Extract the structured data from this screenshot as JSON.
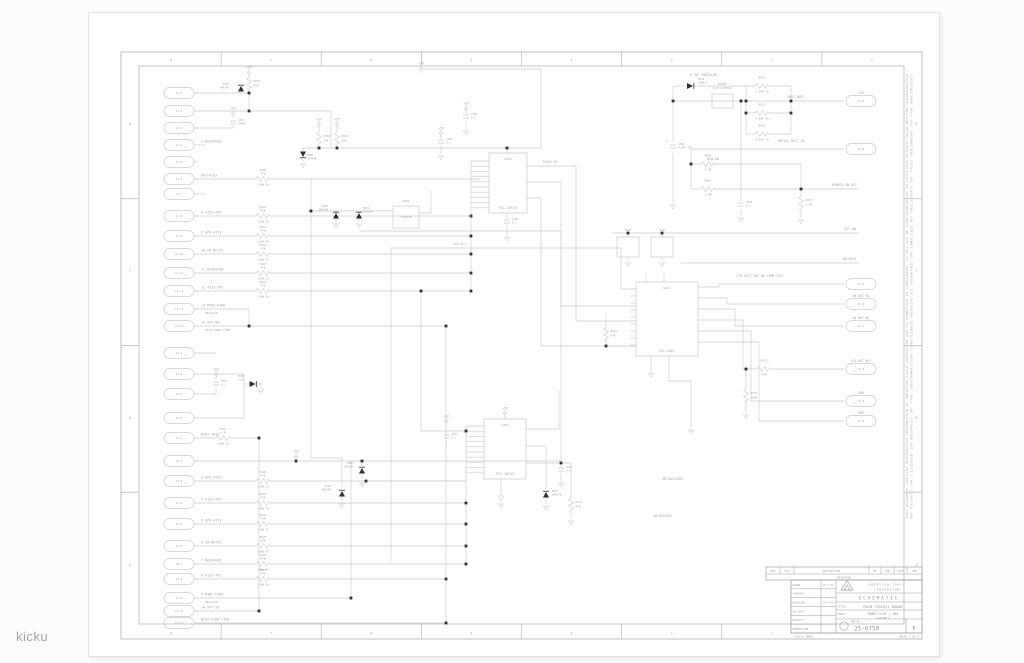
{
  "watermark": "kicku",
  "frame": {
    "zone_columns": [
      "8",
      "7",
      "6",
      "5",
      "4",
      "3",
      "2",
      "1"
    ],
    "zone_rows": [
      "D",
      "C",
      "B",
      "A"
    ],
    "notice_line1": "THIS DOCUMENT CONTAINS PROPRIETARY INFORMATION OF AMERICAN TOUCH CONVERSION AND IS SUBMITTED IN CONFIDENCE. IT MAY NOT BE USED REPRODUCED OR DISCLOSED WITHOUT PRIOR WRITTEN AUTHORIZATION",
    "notice_line2": "NO RIGHTS OR LICENSE IN RESPECT OF THE INFORMATION CONTAINED HEREIN IS GRANTED OR IMPLIED BY DELIVERY OF THIS DOCUMENT TO THE RECIPIENT"
  },
  "title_block": {
    "company_line1": "AMERICAN TOUCH",
    "company_line2": "CONVERSION",
    "doc_type": "SCHEMATIC",
    "title_label": "TITLE:",
    "title": "MAIN CIRCUIT BOARD",
    "model_label": "MODEL:",
    "model": "SMART-SLOT / 485",
    "model_sub": "ASSEMBLY",
    "dwg_label": "DWG NO:",
    "dwg_no": "25-0750",
    "rev": "F",
    "scale": "SCALE: NONE",
    "sheet": "SHEET 1 OF 1",
    "revisions_caption": "REVISIONS",
    "rev_header": [
      "REV",
      "ECO",
      "DESCRIPTION",
      "BY",
      "CHK",
      "DATE",
      "APP"
    ],
    "approvals": [
      {
        "label": "DRAWN",
        "date": "10-5-94"
      },
      {
        "label": "CHECKED",
        "date": ""
      },
      {
        "label": "RELEASED",
        "date": "10-5-94"
      },
      {
        "label": "DOC REP",
        "date": ""
      },
      {
        "label": "QUALITY",
        "date": ""
      },
      {
        "label": "PRODUCTION",
        "date": ""
      }
    ]
  },
  "schematic": {
    "power_label": "+5V",
    "res_tol": "1/8W 5%",
    "left_connectors": [
      {
        "pin": "J1-1",
        "net": ""
      },
      {
        "pin": "J1-2",
        "net": ""
      },
      {
        "pin": "J1-3",
        "net": ""
      },
      {
        "pin": "J1-4",
        "net": "C-RESERVED"
      },
      {
        "pin": "J1-5",
        "net": ""
      },
      {
        "pin": "J1-6",
        "net": "GPI-4153",
        "res_ref": "R506",
        "res_val": "47K"
      },
      {
        "pin": "J1-7",
        "net": ""
      },
      {
        "pin": "J1-8",
        "net": "8 4153-GPO",
        "res_ref": "R510",
        "res_val": "47K"
      },
      {
        "pin": "J1-9",
        "net": "9 GPO-4153",
        "res_ref": "R511",
        "res_val": "47K"
      },
      {
        "pin": "J1-10",
        "net": "10 CB-BUTTS",
        "res_ref": "R512",
        "res_val": "47K"
      },
      {
        "pin": "J1-11",
        "net": "11 RESERVED",
        "res_ref": "R513",
        "res_val": "47K"
      },
      {
        "pin": "J1-12",
        "net": "12 4153-TR2",
        "res_ref": "R514",
        "res_val": "47K"
      },
      {
        "pin": "J1-13",
        "net": "13 MINI-KIRK",
        "sub": "ON-5ACH"
      },
      {
        "pin": "J1-14",
        "net": "14 OFF-ON",
        "sub": "DIST-KIRK-TIME"
      },
      {
        "pin": "J2-1",
        "net": ""
      },
      {
        "pin": "J2-2",
        "net": ""
      },
      {
        "pin": "J2-3",
        "net": ""
      },
      {
        "pin": "J2-4",
        "net": ""
      },
      {
        "pin": "J3-1",
        "net": "A101-TRIG",
        "res_ref": "R527",
        "res_val": "4.7K"
      },
      {
        "pin": "J3-2",
        "net": ""
      },
      {
        "pin": "J3-3",
        "net": "3 GPA-4153",
        "res_ref": "R520",
        "res_val": "47K"
      },
      {
        "pin": "J3-4",
        "net": "4 4153-GPO",
        "res_ref": "R521",
        "res_val": "47K"
      },
      {
        "pin": "J3-5",
        "net": "5 GPO-4153",
        "res_ref": "R522",
        "res_val": "47K"
      },
      {
        "pin": "J3-6",
        "net": "6 CB-BUTTS",
        "res_ref": "R523",
        "res_val": "47K"
      },
      {
        "pin": "J3-7",
        "net": "7 RESERVED",
        "res_ref": "R524",
        "res_val": "47K"
      },
      {
        "pin": "J3-8",
        "net": "8 4153-TR2",
        "res_ref": "R525",
        "res_val": "47K"
      },
      {
        "pin": "J3-9",
        "net": "9 MINI-KIRK",
        "sub": "ON-5ACH"
      },
      {
        "pin": "J3-10",
        "net": "14 OFF-5A"
      },
      {
        "pin": "J3-11",
        "net": "BIAS-KIRK-TIME"
      }
    ],
    "right_connectors": [
      {
        "id": "J4-A",
        "net": "+5V"
      },
      {
        "id": "J4-B",
        "net": "SERIAL BATT-IN"
      },
      {
        "id": "J5-1",
        "net": "(FM 5472 SW7 NO LAMP FUS)"
      },
      {
        "id": "J5-2",
        "net": "SW BAT W2"
      },
      {
        "id": "J5-3",
        "net": "SW BAT W1"
      },
      {
        "id": "J5-4",
        "net": "(LO BAT NC)"
      },
      {
        "id": "J5-5",
        "net": "VDD"
      },
      {
        "id": "J5-6",
        "net": "VDD"
      }
    ],
    "net_labels": [
      {
        "text": "VBAT-BATT"
      },
      {
        "text": "BLW-ON"
      },
      {
        "text": "REMOTE ON-OFF"
      },
      {
        "text": "OFF-ON"
      },
      {
        "text": "ON-5ACH"
      },
      {
        "text": "R410-74L"
      },
      {
        "text": "SB74AC240SC"
      },
      {
        "text": "SB74AC04SC"
      },
      {
        "text": "+5V 0.1"
      },
      {
        "text": "0.1UF TANTALUM"
      }
    ],
    "ics": [
      {
        "ref": "U202",
        "part": "PIC-16C54"
      },
      {
        "ref": "U601",
        "part": "SSI-2661"
      },
      {
        "ref": "U402",
        "part": "PIC-16C54"
      }
    ],
    "parts": [
      {
        "ref": "BT650",
        "value": "3.6V LITHIUM"
      },
      {
        "ref": "Y601",
        "value": "3.58 MHZ"
      },
      {
        "ref": "Y602",
        "value": "32.768K"
      },
      {
        "ref": "U203",
        "value": "CD4070B"
      }
    ],
    "resistors": [
      {
        "ref": "R501",
        "value": "47K"
      },
      {
        "ref": "R504",
        "value": "10K"
      },
      {
        "ref": "R505",
        "value": "10K"
      },
      {
        "ref": "R651",
        "value": "1.00M 1%"
      },
      {
        "ref": "R652",
        "value": "4.99K 1%"
      },
      {
        "ref": "R653",
        "value": "2.49K 1%"
      },
      {
        "ref": "R660",
        "value": "2.2M"
      },
      {
        "ref": "R661",
        "value": "1.0M"
      },
      {
        "ref": "R663",
        "value": "1.5K"
      },
      {
        "ref": "R571",
        "value": "47K"
      },
      {
        "ref": "R572",
        "value": "100K"
      },
      {
        "ref": "R570",
        "value": "47K"
      },
      {
        "ref": "R531",
        "value": "47K"
      }
    ],
    "caps": [
      {
        "ref": "C202",
        "value": "470PF"
      },
      {
        "ref": "C204",
        "value": "0.1"
      },
      {
        "ref": "C205",
        "value": "0.1"
      },
      {
        "ref": "C206",
        "value": "0.1"
      },
      {
        "ref": "C650",
        "value": "4.7UF 35V"
      },
      {
        "ref": "C652",
        "value": "0.1"
      },
      {
        "ref": "C401",
        "value": "0.1"
      },
      {
        "ref": "C301",
        "value": "0.1"
      },
      {
        "ref": "C521",
        "value": "0.1"
      }
    ],
    "diodes": [
      {
        "ref": "D501",
        "value": "1N4148"
      },
      {
        "ref": "D650",
        "value": "1N5817"
      },
      {
        "ref": "D502",
        "value": "1N4148"
      },
      {
        "ref": "D503",
        "value": "1N4148"
      },
      {
        "ref": "D504",
        "value": "1N4148"
      },
      {
        "ref": "D500",
        "value": "6.8V"
      },
      {
        "ref": "D505",
        "value": "1N4148"
      },
      {
        "ref": "D506",
        "value": "1N4148"
      },
      {
        "ref": "D507",
        "value": "1N4148"
      }
    ]
  }
}
